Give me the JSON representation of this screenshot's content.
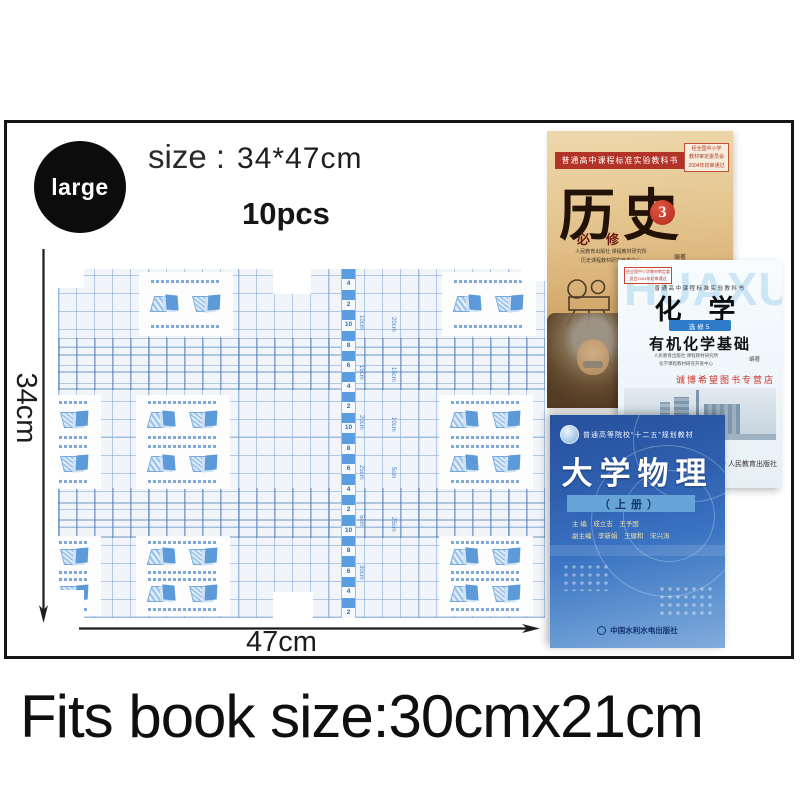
{
  "badge": {
    "label": "large"
  },
  "header": {
    "size_label": "size :",
    "size_value": "34*47cm",
    "quantity": "10pcs"
  },
  "dimensions": {
    "height_label": "34cm",
    "width_label": "47cm"
  },
  "caption": "Fits book size:30cmx21cm",
  "film": {
    "ruler_numbers": [
      "4",
      "2",
      "10",
      "8",
      "6",
      "4",
      "2",
      "10",
      "8",
      "6",
      "4",
      "2",
      "10",
      "8",
      "6",
      "4",
      "2"
    ],
    "ruler_labels_left": [
      "10cm",
      "15cm",
      "20cm",
      "25cm",
      "5cm",
      "30cm"
    ],
    "ruler_labels_right": [
      "20cm",
      "15cm",
      "10cm",
      "5cm",
      "25cm"
    ]
  },
  "books": {
    "history": {
      "series": "普通高中课程标准实验教科书",
      "approval_lines": [
        "经全国中小学",
        "教材审定委员会",
        "2004年初审通过"
      ],
      "title": "历史",
      "volume_badge": "3",
      "subtitle": "必修",
      "authors_line1": "人民教育出版社 课程教材研究所",
      "authors_line2": "历史课程教材研究开发中心",
      "edit_label": "编著"
    },
    "chemistry": {
      "watermark": "HUAXUE",
      "approval_lines": [
        "经全国中小学教材审定委",
        "员会2004年初审通过"
      ],
      "series": "普通高中课程标准实验教科书",
      "title": "化 学",
      "module": "选修5",
      "subtitle": "有机化学基础",
      "authors_line1": "人民教育出版社 课程教材研究所",
      "authors_line2": "化学课程教材研究开发中心",
      "edit_label": "编著",
      "store_watermark": "诚博希望图书专营店",
      "publisher": "人民教育出版社"
    },
    "physics": {
      "series": "普通高等院校“十二五”规划教材",
      "title": "大学物理",
      "volume": "（上册）",
      "editors_line1": "主 编　成立志　王予国",
      "editors_line2": "副主编　李新娟　王健和　宋兴涛",
      "publisher": "中国水利水电出版社"
    }
  },
  "colors": {
    "film_grid": "#7da5d7",
    "ruler_blue": "#5a9de0",
    "banner_red": "#b23328",
    "physics_blue": "#2e5fae",
    "module_blue": "#2e7cc9"
  }
}
